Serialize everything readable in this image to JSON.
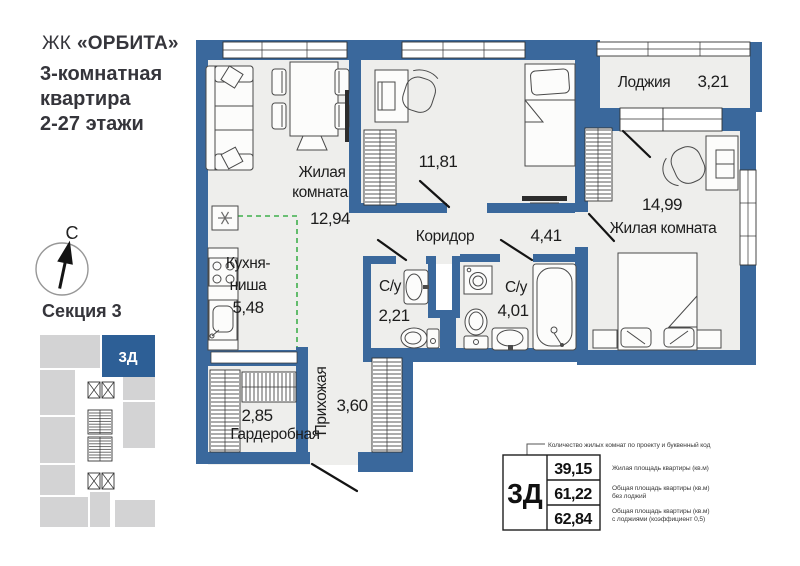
{
  "header": {
    "prefix": "ЖК",
    "name": "«ОРБИТА»",
    "lines": [
      "3-комнатная",
      "квартира",
      "2-27 этажи"
    ]
  },
  "compass": {
    "north": "С"
  },
  "section": {
    "title": "Секция 3",
    "unit": "3Д"
  },
  "rooms": {
    "living1": {
      "name1": "Жилая",
      "name2": "комната",
      "area": "12,94"
    },
    "kitchen": {
      "name1": "Кухня-",
      "name2": "ниша",
      "area": "5,48"
    },
    "bedroom2": {
      "area": "11,81"
    },
    "corridor": {
      "name": "Коридор",
      "area": "4,41"
    },
    "loggia": {
      "name": "Лоджия",
      "area": "3,21"
    },
    "living2": {
      "name": "Жилая комната",
      "area": "14,99"
    },
    "bath1": {
      "name": "С/у",
      "area": "2,21"
    },
    "bath2": {
      "name": "С/у",
      "area": "4,01"
    },
    "hallway": {
      "name": "Прихожая",
      "area": "3,60"
    },
    "wardrobe": {
      "name": "Гардеробная",
      "area": "2,85"
    }
  },
  "legend": {
    "pointer": "Количество жилых комнат по проекту и буквенный код",
    "unit": "3Д",
    "rows": [
      {
        "value": "39,15",
        "l1": "Жилая площадь квартиры (кв.м)",
        "l2": ""
      },
      {
        "value": "61,22",
        "l1": "Общая площадь квартиры (кв.м)",
        "l2": "без лоджий"
      },
      {
        "value": "62,84",
        "l1": "Общая площадь квартиры (кв.м)",
        "l2": "с лоджиями (коэффициент 0,5)"
      }
    ]
  },
  "colors": {
    "wall": "#3a689c",
    "room_fill": "#eeeeec",
    "accent": "#2d5f96",
    "kitchen_dash": "#3faf4c"
  }
}
